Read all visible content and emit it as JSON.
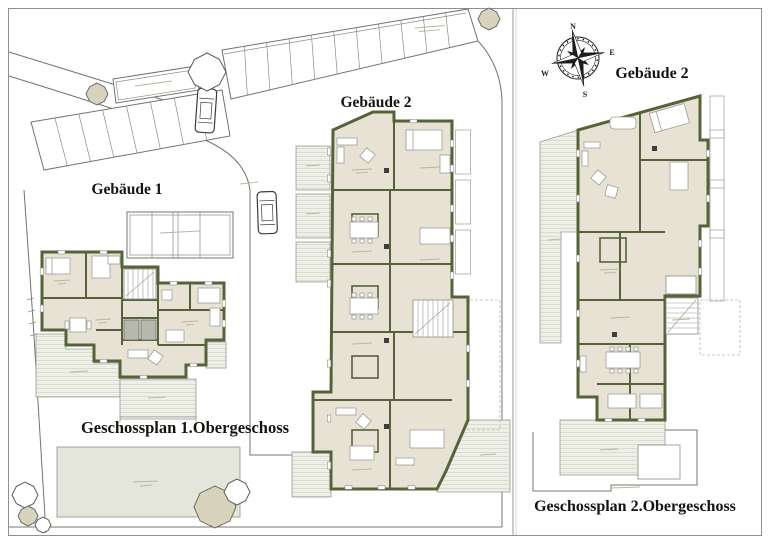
{
  "labels": {
    "building1": "Gebäude 1",
    "building2_site": "Gebäude 2",
    "building2_upper": "Gebäude 2",
    "caption_floor1": "Geschossplan 1.Obergeschoss",
    "caption_floor2": "Geschossplan 2.Obergeschoss"
  },
  "compass": {
    "n": "N",
    "e": "E",
    "s": "S",
    "w": "W"
  },
  "colors": {
    "wall": "#56633a",
    "floor": "#e8e2d4",
    "terrace_bg": "#eef0e8",
    "terrace_line": "#d5d7ca",
    "lawn": "#e4e6dc",
    "tree_fill": "#d7d3bd",
    "line": "#74746e",
    "thin": "#8b8b86",
    "furn": "#9d9d98",
    "dark_cell": "#b5b8ab",
    "appliance": "#3e3e38",
    "text": "#14140f",
    "mark": "#bdb5a1"
  }
}
